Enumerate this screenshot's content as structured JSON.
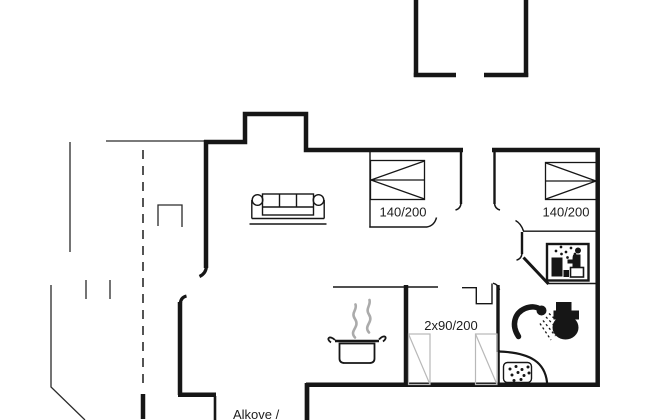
{
  "plan": {
    "title": "holiday-home-floor-plan",
    "labels": {
      "bed_left": "140/200",
      "bed_right": "140/200",
      "bunk_beds": "2x90/200",
      "alcove": "Alkove /"
    },
    "colors": {
      "wall": "#161616",
      "thin_line": "#2a2a2a",
      "light_gray": "#b8b8b8",
      "steam": "#ababab",
      "text": "#1d1d1d",
      "background": "#ffffff"
    },
    "icons": [
      "sofa-icon",
      "double-bed-icon-left",
      "double-bed-icon-right",
      "bunk-beds-icon",
      "cooking-pot-icon",
      "steam-icon",
      "shower-icon",
      "toilet-icon",
      "washbasin-icon",
      "washing-machine-icon",
      "door-swing-icon"
    ]
  }
}
